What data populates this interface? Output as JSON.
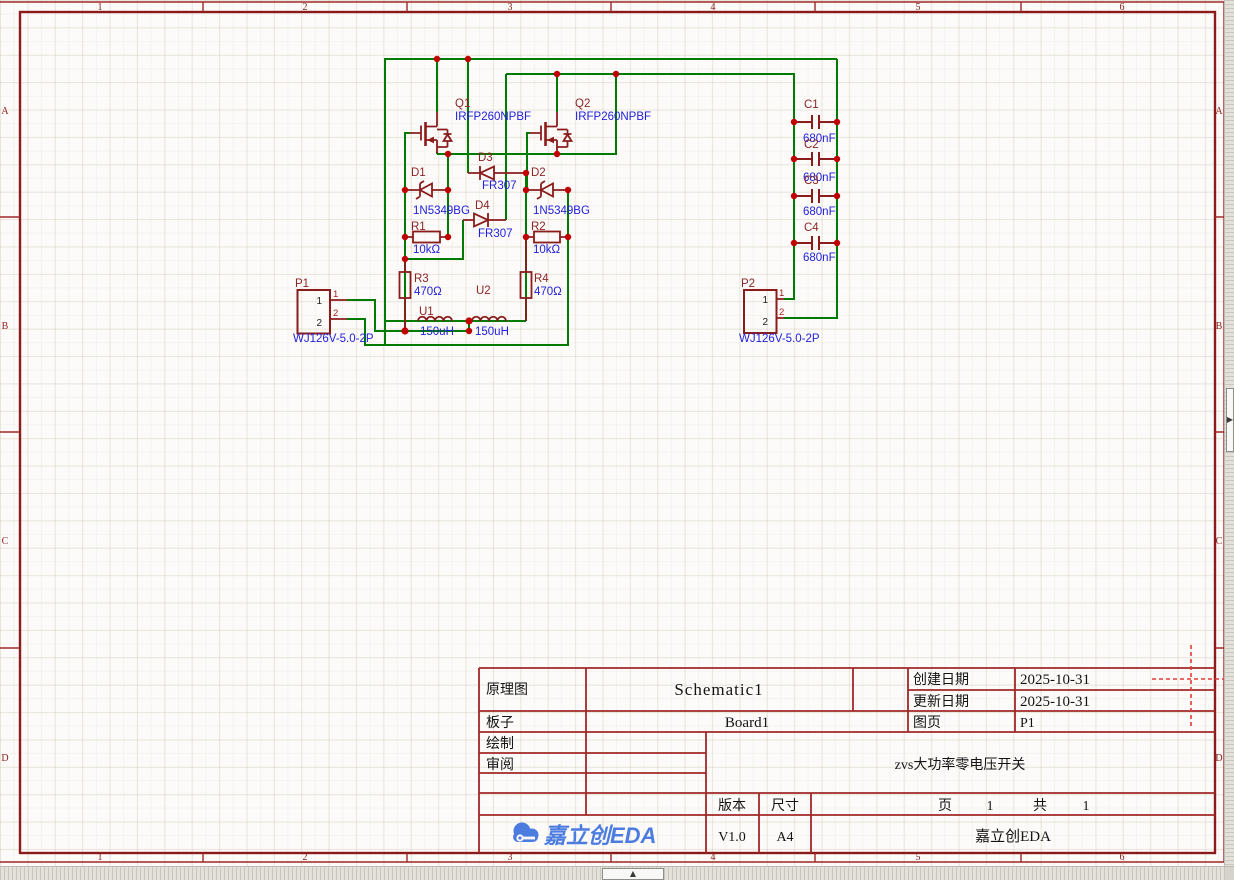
{
  "app": {
    "name": "EasyEDA schematic canvas",
    "vendor_logo_text": "嘉立创EDA",
    "logo_color": "#4D7CE0"
  },
  "sheet": {
    "ruler_columns": [
      "1",
      "2",
      "3",
      "4",
      "5",
      "6"
    ],
    "ruler_rows": [
      "A",
      "B",
      "C",
      "D"
    ]
  },
  "icons": {
    "panel_expand_up": "▲",
    "panel_expand_right": "▶"
  },
  "colors": {
    "wire": "#007A00",
    "symbol": "#8A1C1C",
    "junction": "#C00000",
    "frame": "#A02828",
    "designator_text": "#8B2525",
    "value_text": "#1E1EDC"
  },
  "schematic": {
    "pin_numbers": [
      "1",
      "2"
    ],
    "components": [
      {
        "refdes": "Q1",
        "value": "IRFP260NPBF",
        "type": "nmos"
      },
      {
        "refdes": "Q2",
        "value": "IRFP260NPBF",
        "type": "nmos"
      },
      {
        "refdes": "D1",
        "value": "1N5349BG",
        "type": "zener"
      },
      {
        "refdes": "D2",
        "value": "1N5349BG",
        "type": "zener"
      },
      {
        "refdes": "D3",
        "value": "FR307",
        "type": "diode"
      },
      {
        "refdes": "D4",
        "value": "FR307",
        "type": "diode"
      },
      {
        "refdes": "R1",
        "value": "10kΩ",
        "type": "resistor"
      },
      {
        "refdes": "R2",
        "value": "10kΩ",
        "type": "resistor"
      },
      {
        "refdes": "R3",
        "value": "470Ω",
        "type": "resistor"
      },
      {
        "refdes": "R4",
        "value": "470Ω",
        "type": "resistor"
      },
      {
        "refdes": "U1",
        "value": "150uH",
        "type": "inductor"
      },
      {
        "refdes": "U2",
        "value": "150uH",
        "type": "inductor"
      },
      {
        "refdes": "C1",
        "value": "680nF",
        "type": "capacitor"
      },
      {
        "refdes": "C2",
        "value": "680nF",
        "type": "capacitor"
      },
      {
        "refdes": "C3",
        "value": "680nF",
        "type": "capacitor"
      },
      {
        "refdes": "C4",
        "value": "680nF",
        "type": "capacitor"
      },
      {
        "refdes": "P1",
        "value": "WJ126V-5.0-2P",
        "type": "connector"
      },
      {
        "refdes": "P2",
        "value": "WJ126V-5.0-2P",
        "type": "connector"
      }
    ]
  },
  "title_block": {
    "schematic_label": "原理图",
    "schematic_value": "Schematic1",
    "board_label": "板子",
    "board_value": "Board1",
    "drawn_label": "绘制",
    "reviewed_label": "审阅",
    "created_label": "创建日期",
    "created_value": "2025-10-31",
    "updated_label": "更新日期",
    "updated_value": "2025-10-31",
    "sheet_label": "图页",
    "sheet_value": "P1",
    "version_label": "版本",
    "version_value": "V1.0",
    "size_label": "尺寸",
    "size_value": "A4",
    "page_label": "页",
    "page_current": "1",
    "pages_total_label": "共",
    "pages_total": "1",
    "title": "zvs大功率零电压开关",
    "company": "嘉立创EDA"
  }
}
